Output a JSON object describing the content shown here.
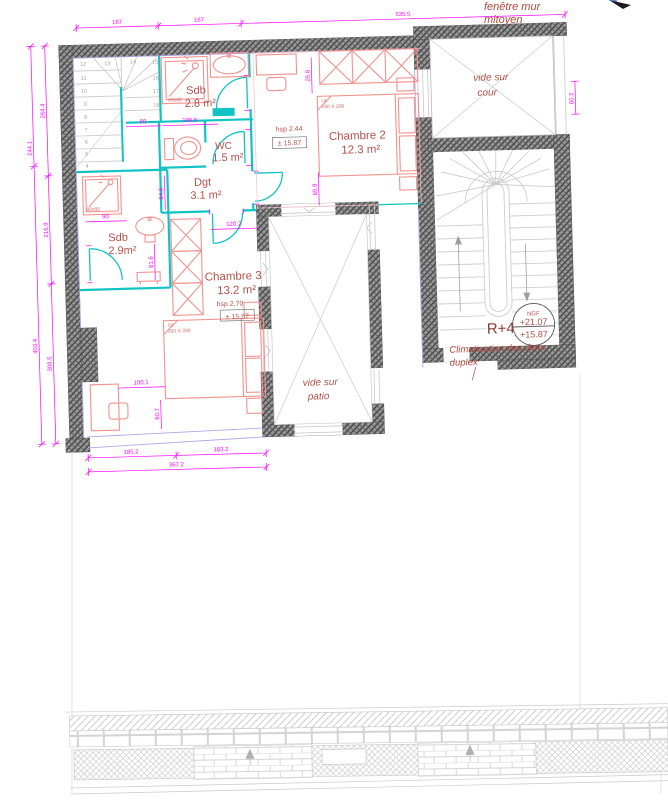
{
  "annotations": {
    "window_note_line1": "fenêtre mur",
    "window_note_line2": "mitoyen",
    "climatisation_line1": "Climatisation des deux",
    "climatisation_line2": "duplex",
    "level_label": "R+4",
    "ngf_label": "NGF",
    "ngf_upper": "+21.07",
    "ngf_lower": "+15.87"
  },
  "rooms": {
    "sdb_top": {
      "name": "Sdb",
      "area": "2.8 m²"
    },
    "wc": {
      "name": "WC",
      "area": "1.5 m²"
    },
    "dgt": {
      "name": "Dgt",
      "area": "3.1 m²"
    },
    "chambre2": {
      "name": "Chambre 2",
      "area": "12.3 m²",
      "hsp": "hsp 2.44",
      "level": "± 15.87"
    },
    "sdb_bottom": {
      "name": "Sdb",
      "area": "2.9m²"
    },
    "chambre3": {
      "name": "Chambre 3",
      "area": "13.2 m²",
      "hsp": "hsp 2.70",
      "level": "± 15.87"
    },
    "cour_line1": "vide sur",
    "cour_line2": "cour",
    "patio_line1": "vide sur",
    "patio_line2": "patio"
  },
  "furniture": {
    "shower_top_label": "80x80",
    "shower_bottom_label": "80x80",
    "bed_prefix": "Lit",
    "bed2_label": "160 X 200",
    "bed3_label": "160 X 200"
  },
  "dimensions": {
    "top": [
      "167",
      "167",
      "535.5"
    ],
    "left_outer": [
      "244.1",
      "403.4"
    ],
    "left_inner": [
      "264.4",
      "216.9",
      "308.5"
    ],
    "right": "60.2",
    "bottom_chain": [
      "185.2",
      "183.2"
    ],
    "bottom_total": "367.2",
    "interior": {
      "d80": "80",
      "d106": "106.6",
      "d84": "84.6",
      "d120": "120.2",
      "d90": "90",
      "d81": "81.6",
      "d100": "100.1",
      "d60": "60.7",
      "d25": "25.8",
      "d65": "65.9"
    }
  },
  "stair_numbers": [
    "4",
    "5",
    "6",
    "7",
    "8",
    "9",
    "10",
    "11",
    "12",
    "13",
    "14",
    "15",
    "16",
    "17",
    "18"
  ],
  "colors": {
    "dimension": "#ff00ff",
    "partition": "#12c3c3",
    "furniture": "#f2928f",
    "label": "#b2524a",
    "wall": "#555555",
    "glazing": "#b3a6e6"
  }
}
